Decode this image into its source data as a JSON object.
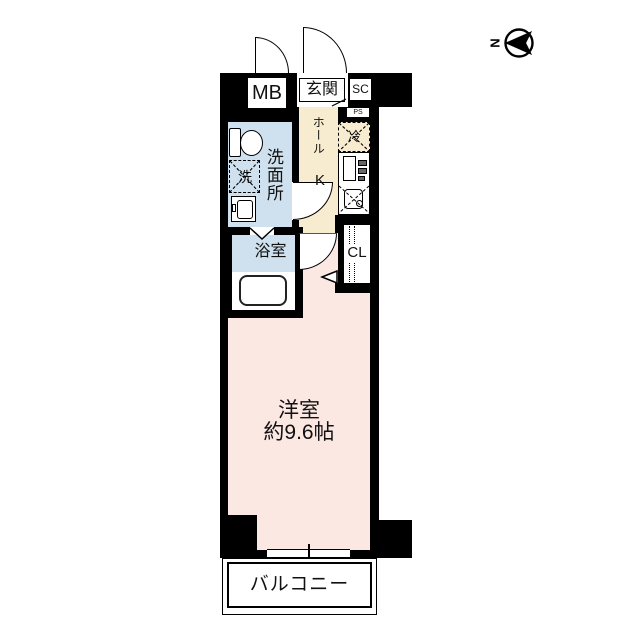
{
  "title": "apartment-floor-plan",
  "compass": {
    "label": "N"
  },
  "labels": {
    "meter_box": "MB",
    "entrance": "玄関",
    "shoe_closet": "SC",
    "pipe_space": "PS",
    "hall": "ホール",
    "kitchen": "K",
    "refrigerator": "冷",
    "washroom": "洗面所",
    "washing_machine": "洗",
    "bathroom": "浴室",
    "closet": "CL",
    "main_room_name": "洋室",
    "main_room_size": "約9.6帖",
    "balcony": "バルコニー"
  },
  "colors": {
    "wall": "#000000",
    "wet_area_floor": "#cfe1ee",
    "hall_floor": "#f8ecd0",
    "main_room_floor": "#fbe8e2",
    "background": "#ffffff"
  }
}
